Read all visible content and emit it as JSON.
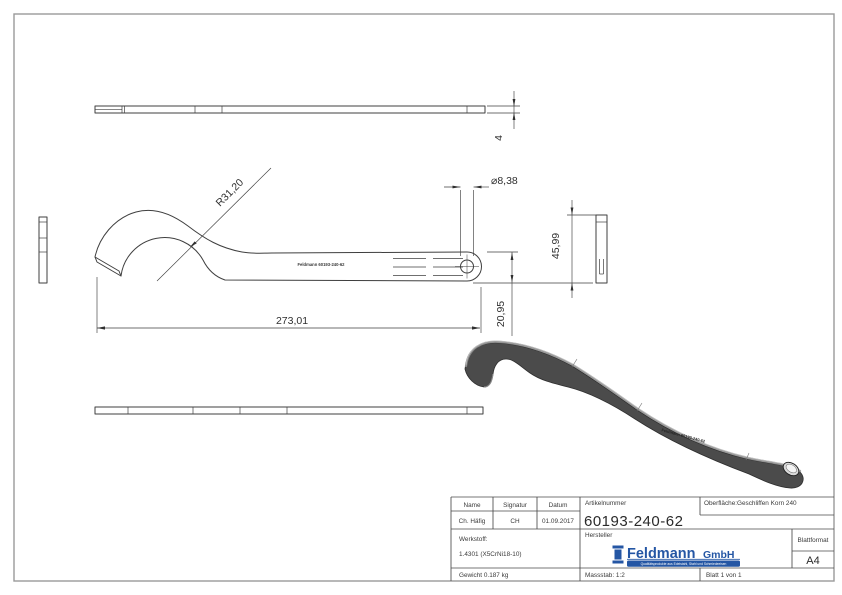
{
  "drawing": {
    "dimensions": {
      "thickness": "4",
      "radius": "R31,20",
      "hole_diameter": "⌀8,38",
      "length": "273,01",
      "end_height": "20,95",
      "side_height": "45,99"
    },
    "engraving_2d": "Feldmann 60193-240-62",
    "engraving_3d": "Feldmann 60193-240-62"
  },
  "title_block": {
    "name_header": "Name",
    "signature_header": "Signatur",
    "date_header": "Datum",
    "name_value": "Ch. Häfig",
    "signature_value": "CH",
    "date_value": "01.09.2017",
    "article_number_label": "Artikelnummer",
    "article_number": "60193-240-62",
    "surface_label": "Oberfläche:",
    "surface_value": "Geschliffen Korn 240",
    "material_label": "Werkstoff:",
    "material_value": "1.4301 (X5CrNi18-10)",
    "manufacturer_label": "Hersteller",
    "sheet_format_label": "Blattformat",
    "sheet_format_value": "A4",
    "weight": "Gewicht 0.187 kg",
    "scale": "Massstab: 1:2",
    "sheet": "Blatt 1 von 1",
    "logo": {
      "brand": "Feldmann",
      "suffix": "GmbH",
      "tagline": "Qualitätsprodukte aus Edelstahl, Stahl und Schmiedeeisen"
    }
  },
  "colors": {
    "line": "#3f3f3f",
    "frame": "#9a9a9a",
    "logo_blue": "#2456a4",
    "render_body": "#4b4b4b",
    "render_highlight": "#8f8f8f"
  }
}
